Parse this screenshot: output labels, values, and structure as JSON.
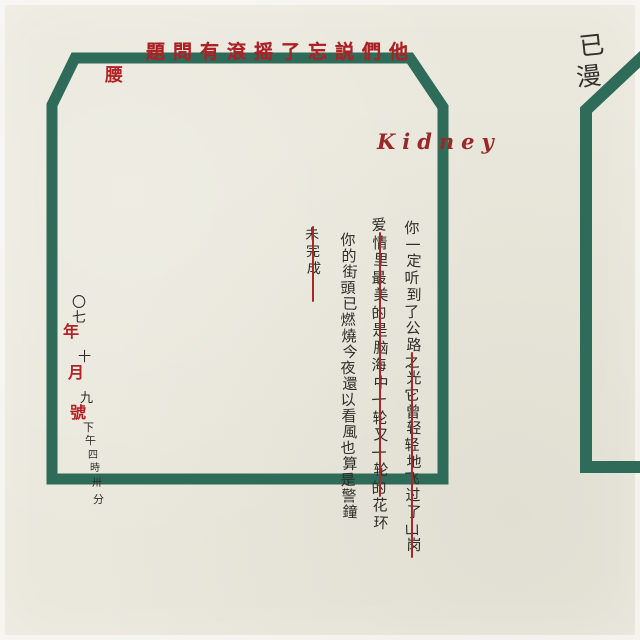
{
  "palette": {
    "background": "#eae8dc",
    "frame_green": "#2e6b59",
    "headline_red": "#ab2126",
    "strike_red": "#a32a2c",
    "ink": "#2f2d28"
  },
  "headline": {
    "text": "題問有滾摇了忘説們他"
  },
  "waist_label": {
    "text": "腰"
  },
  "kidney_label": {
    "text": "Kidney"
  },
  "corner_note": {
    "chars": [
      {
        "ch": "已",
        "x": 579,
        "y": 26,
        "size": 25
      },
      {
        "ch": "漫",
        "x": 576,
        "y": 57,
        "size": 25
      }
    ]
  },
  "lyrics": {
    "columns": [
      {
        "name": "column-1",
        "text": "你一定听到了公路之光它曾轻轻地飞过了山岗",
        "x": 413,
        "y": 221,
        "size": 15,
        "spacing": 16.7
      },
      {
        "name": "column-2",
        "text": "爱情里最美的是脑海中一轮又一轮的花环",
        "x": 380,
        "y": 218,
        "size": 15,
        "spacing": 17.5
      },
      {
        "name": "column-3",
        "text": "你的街頭已燃燒今夜還以看風也算是警鐘",
        "x": 349,
        "y": 233,
        "size": 15,
        "spacing": 16
      },
      {
        "name": "column-4",
        "text": "未完成",
        "x": 313,
        "y": 228,
        "size": 14,
        "spacing": 17
      }
    ],
    "strike_lines": [
      {
        "x": 411,
        "y1": 352,
        "y2": 558
      },
      {
        "x": 379,
        "y1": 232,
        "y2": 497
      },
      {
        "x": 312,
        "y1": 226,
        "y2": 302
      }
    ]
  },
  "date_column": {
    "chars": [
      {
        "ch": "〇",
        "x": 72,
        "y": 296,
        "size": 14,
        "cls": "ink"
      },
      {
        "ch": "七",
        "x": 72,
        "y": 311,
        "size": 14,
        "cls": "ink"
      },
      {
        "ch": "年",
        "x": 63,
        "y": 324,
        "size": 16,
        "cls": "red"
      },
      {
        "ch": "十",
        "x": 78,
        "y": 351,
        "size": 13,
        "cls": "ink"
      },
      {
        "ch": "月",
        "x": 68,
        "y": 365,
        "size": 16,
        "cls": "red"
      },
      {
        "ch": "九",
        "x": 80,
        "y": 392,
        "size": 13,
        "cls": "ink"
      },
      {
        "ch": "號",
        "x": 70,
        "y": 405,
        "size": 16,
        "cls": "red"
      },
      {
        "ch": "下",
        "x": 83,
        "y": 422,
        "size": 11,
        "cls": "ink"
      },
      {
        "ch": "午",
        "x": 85,
        "y": 435,
        "size": 11,
        "cls": "ink"
      },
      {
        "ch": "四",
        "x": 88,
        "y": 451,
        "size": 10,
        "cls": "ink"
      },
      {
        "ch": "時",
        "x": 90,
        "y": 464,
        "size": 10,
        "cls": "ink"
      },
      {
        "ch": "卅",
        "x": 92,
        "y": 479,
        "size": 10,
        "cls": "ink"
      },
      {
        "ch": "分",
        "x": 93,
        "y": 494,
        "size": 11,
        "cls": "ink"
      }
    ]
  },
  "frames": {
    "main_frame_path": "M52,105 L75,58 L410,58 L443,107 L443,479 L52,479 Z",
    "right_frame_path": "M652,48 L586,110 L586,467 L652,467"
  }
}
